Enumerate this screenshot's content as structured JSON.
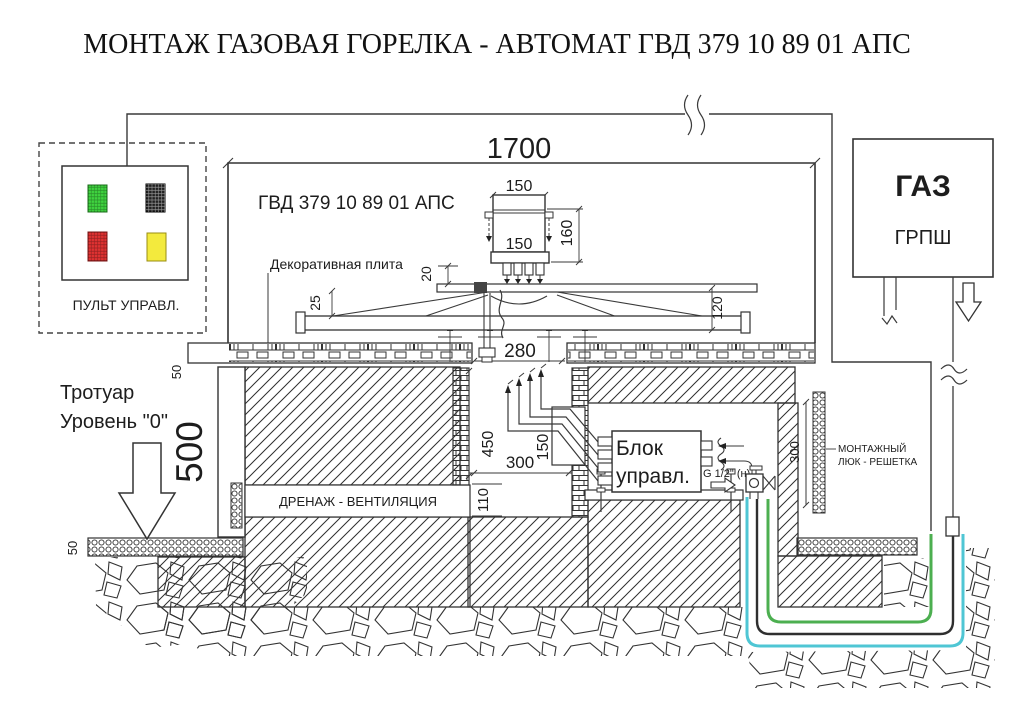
{
  "title": "МОНТАЖ ГАЗОВАЯ ГОРЕЛКА - АВТОМАТ ГВД 379 10 89 01 АПС",
  "control_panel": {
    "label": "ПУЛЬТ УПРАВЛ."
  },
  "enclosure": {
    "width_dim": "1700",
    "label": "ГВД 379 10 89 01 АПС"
  },
  "burner": {
    "dim_width_top": "150",
    "dim_width_inner": "150",
    "dim_height": "160"
  },
  "plate": {
    "label": "Декоративная плита",
    "dim_gap": "20",
    "dim_edge": "25",
    "dim_height": "120",
    "dim_opening": "280"
  },
  "gas_cabinet": {
    "name": "ГАЗ",
    "type": "ГРПШ"
  },
  "street": {
    "line1": "Тротуар",
    "line2": "Уровень \"0\"",
    "sidewalk_dim": "50",
    "paving_dim": "50",
    "depth_dim": "500"
  },
  "chamber": {
    "drainage_label": "ДРЕНАЖ - ВЕНТИЛЯЦИЯ",
    "dim_450": "450",
    "dim_150": "150",
    "dim_300": "300",
    "dim_110": "110"
  },
  "control_block": {
    "line1": "Блок",
    "line2": "управл.",
    "fitting": "G 1/2\" (н)"
  },
  "service_hatch": {
    "dim": "300",
    "label_line1": "МОНТАЖНЫЙ",
    "label_line2": "ЛЮК - РЕШЕТКА"
  },
  "colors": {
    "pipe_cyan": "#4fc6d4",
    "pipe_green": "#4caf50",
    "lamp_green": "#3fd43f",
    "lamp_dark": "#1f1f1f",
    "lamp_red": "#e03232",
    "lamp_yellow": "#f3ea3d"
  }
}
